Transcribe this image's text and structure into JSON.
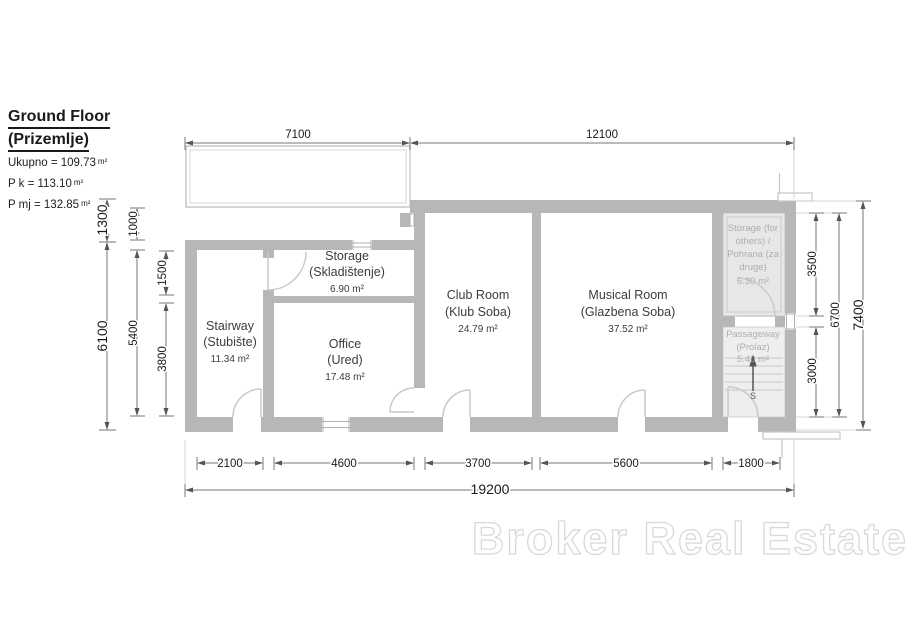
{
  "title": {
    "line1": "Ground Floor",
    "line2": "(Prizemlje)"
  },
  "stats": [
    {
      "text": "Ukupno = 109.73",
      "unit": "m²"
    },
    {
      "text": "P k = 113.10",
      "unit": "m²"
    },
    {
      "text": "P mj = 132.85",
      "unit": "m²"
    }
  ],
  "rooms": {
    "stairway": {
      "name": "Stairway",
      "native": "(Stubište)",
      "area": "11.34 m²"
    },
    "storage": {
      "name": "Storage",
      "native": "(Skladištenje)",
      "area": "6.90 m²"
    },
    "office": {
      "name": "Office",
      "native": "(Ured)",
      "area": "17.48 m²"
    },
    "club_room": {
      "name": "Club Room",
      "native": "(Klub Soba)",
      "area": "24.79 m²"
    },
    "musical_room": {
      "name": "Musical Room",
      "native": "(Glazbena Soba)",
      "area": "37.52 m²"
    },
    "storage_others": {
      "lines": [
        "Storage (for",
        "others) /",
        "Pohrana (za",
        "druge)",
        "6.30 m²"
      ]
    },
    "passageway": {
      "name": "Passageway",
      "native": "(Prolaz)",
      "area": "5.40 m²",
      "stairs_label": "S"
    }
  },
  "dims": {
    "top": [
      "7100",
      "12100"
    ],
    "bottom": [
      "2100",
      "4600",
      "3700",
      "5600",
      "1800"
    ],
    "total_width": "19200",
    "left_outer": [
      "1300",
      "6100"
    ],
    "left_mid": [
      "1000",
      "5400"
    ],
    "left_inner": [
      "1500",
      "3800"
    ],
    "right_inner": [
      "3500",
      "3000"
    ],
    "right_mid": "6700",
    "right_outer": "7400"
  },
  "watermark": "Broker Real Estate"
}
